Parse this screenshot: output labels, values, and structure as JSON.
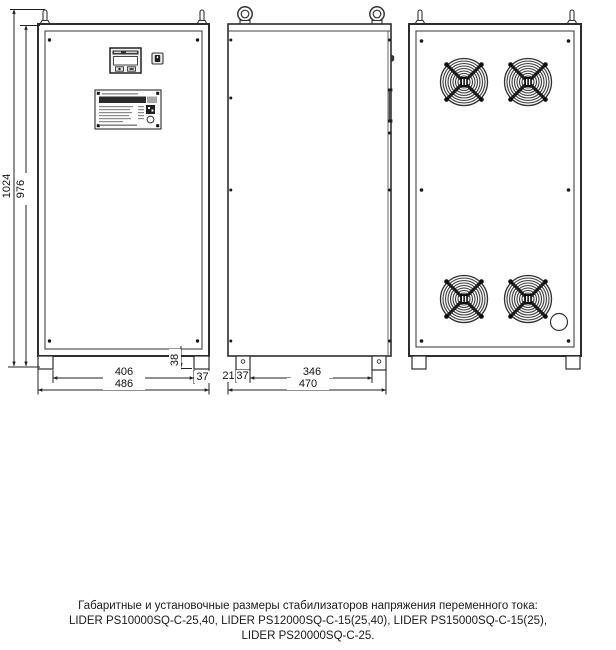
{
  "dims": {
    "total_height": "1024",
    "body_height": "976",
    "front_feet_span": "406",
    "front_overall_width": "486",
    "foot_height": "38",
    "front_foot_width": "37",
    "side_edge_offset": "21",
    "side_foot_width": "37",
    "side_feet_span": "346",
    "side_overall_depth": "470"
  },
  "caption": {
    "line1": "Габаритные и установочные размеры стабилизаторов напряжения переменного тока:",
    "line2": "LIDER PS10000SQ-C-25,40, LIDER PS12000SQ-C-15(25,40), LIDER PS15000SQ-C-15(25),",
    "line3": "LIDER PS20000SQ-C-25."
  },
  "colors": {
    "line": "#333333",
    "background": "#ffffff",
    "fan_dark": "#1c1c1c"
  }
}
